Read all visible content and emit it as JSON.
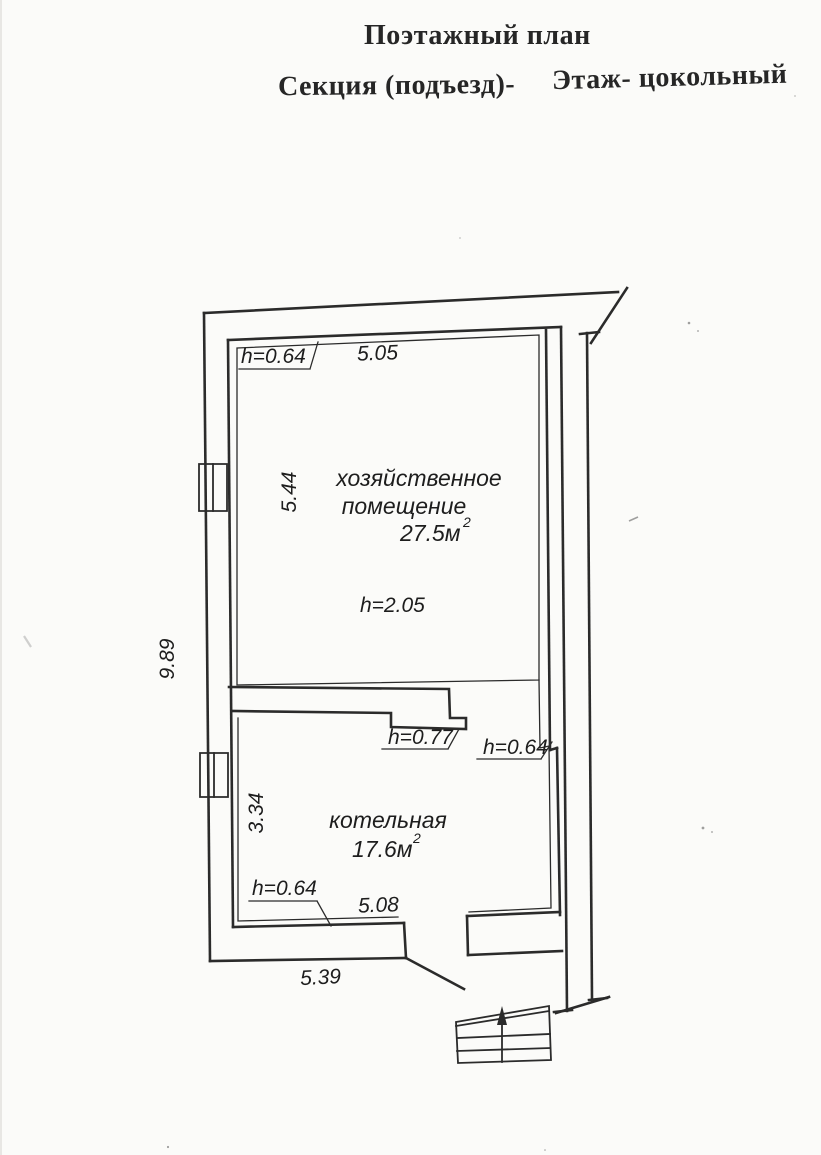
{
  "colors": {
    "paper": "#fbfbf9",
    "ink": "#2b2b2b",
    "text": "#1d1d1d"
  },
  "header": {
    "title": "Поэтажный план",
    "section": "Секция (подъезд)-",
    "floor": "Этаж- цокольный"
  },
  "rooms": [
    {
      "line1": "хозяйственное",
      "line2": "помещение",
      "area": "27.5м",
      "area_sup": "2",
      "ceiling": "h=2.05"
    },
    {
      "line1": "котельная",
      "area": "17.6м",
      "area_sup": "2"
    }
  ],
  "dims": {
    "top": "5.05",
    "room1_left": "5.44",
    "overall_left": "9.89",
    "room2_left": "3.34",
    "room2_bottom": "5.08",
    "bottom": "5.39"
  },
  "marks": {
    "top_left": "h=0.64",
    "partition": "h=0.77",
    "right": "h=0.64",
    "bottom_left": "h=0.64"
  },
  "icons": {
    "stairs": "stairs-up-arrow"
  }
}
